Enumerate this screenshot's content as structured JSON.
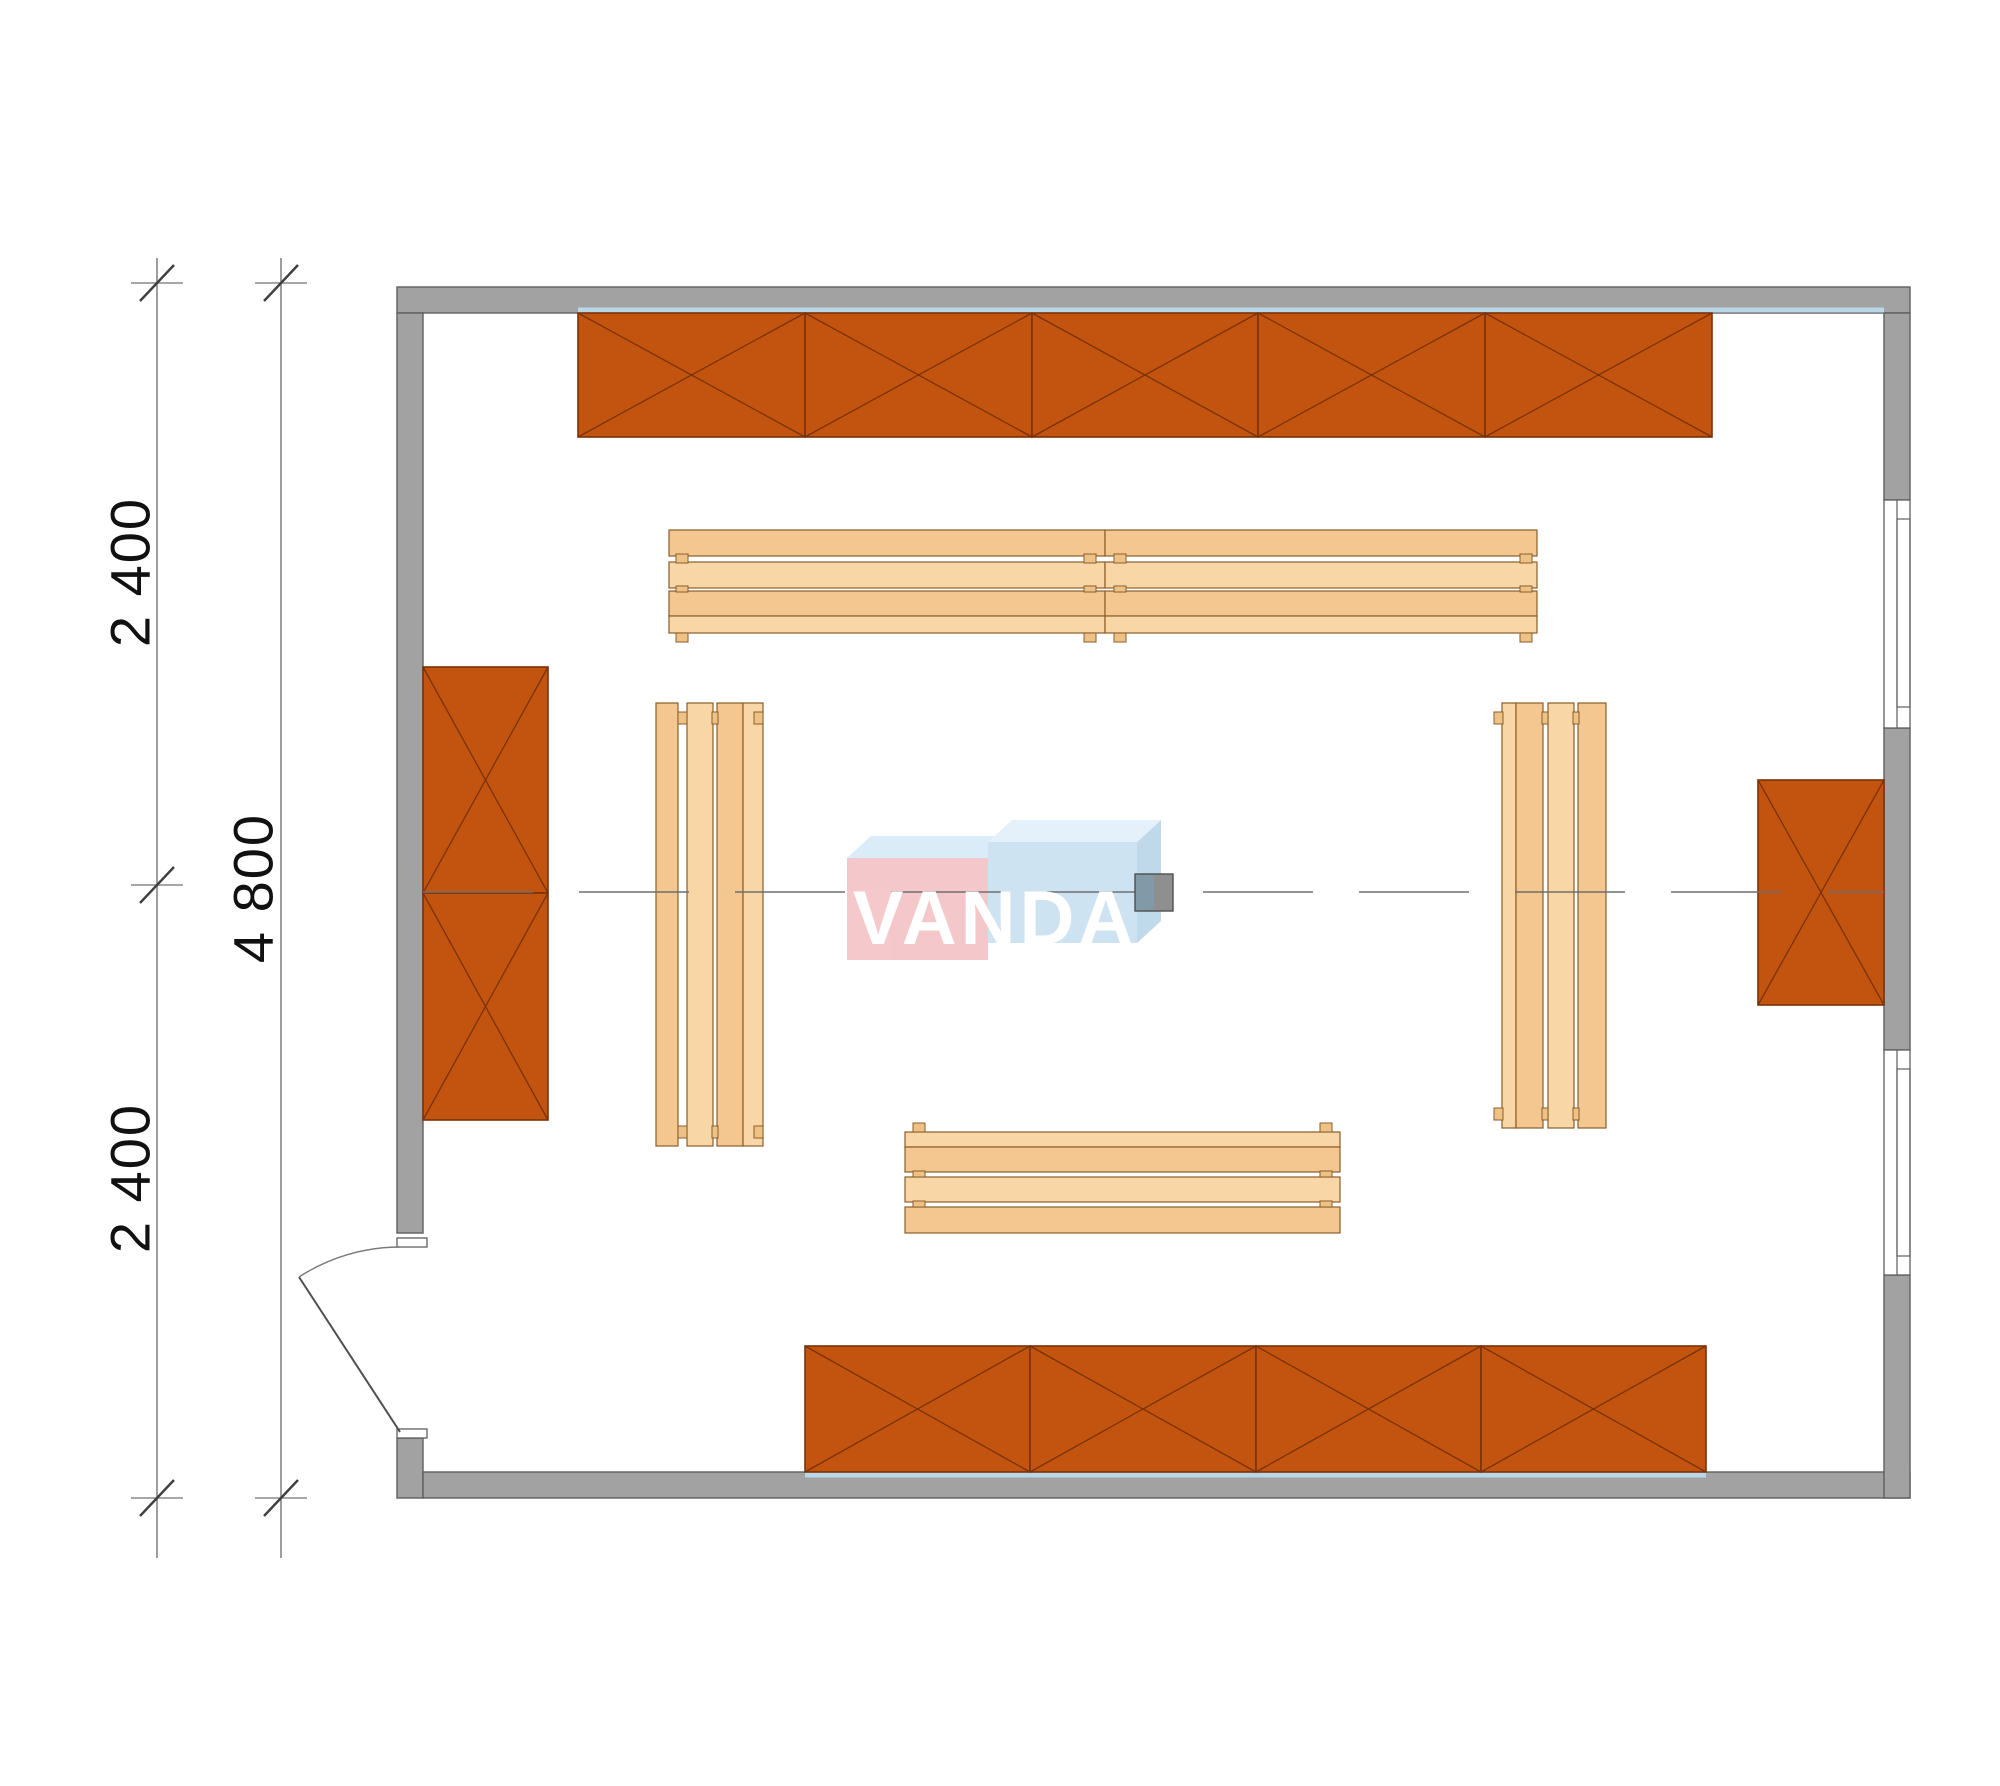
{
  "drawing": {
    "kind": "architectural floor plan, top view",
    "watermark": {
      "full": "VANDA",
      "left_part": "VAN",
      "right_part": "DA"
    }
  },
  "dimensions": {
    "left_top": "2 400",
    "left_bottom": "2 400",
    "overall": "4 800"
  },
  "elements": {
    "crossed_shelf_sections": {
      "top_wall": 5,
      "left_wall": 2,
      "right_wall": 1,
      "bottom_wall": 4
    },
    "benches": {
      "top_row_units": 2,
      "left_vertical": 1,
      "right_vertical": 1,
      "bottom_horizontal": 1
    },
    "windows_right_wall": 2,
    "doors_bottom_left": 1,
    "center_post": 1
  },
  "colors": {
    "wall": "#a2a2a2",
    "wall_outline": "#5f5f5f",
    "shelf_fill": "#c2540f",
    "shelf_line": "#7b3207",
    "bench_fill_light": "#f9d6a6",
    "bench_fill_dark": "#f3c78f",
    "bench_line": "#8a5e2b",
    "centerline": "#6f6f6f",
    "dimension_line": "#7f7f7f",
    "dimension_text": "#111111",
    "watermark_pink": "#f4c6c9",
    "watermark_blue": "#cbe2f1",
    "watermark_top_face": "#dcecf8",
    "finish_strip": "#b9d7e6",
    "post_left": "#8299a7",
    "post_right": "#8f8f8f"
  }
}
